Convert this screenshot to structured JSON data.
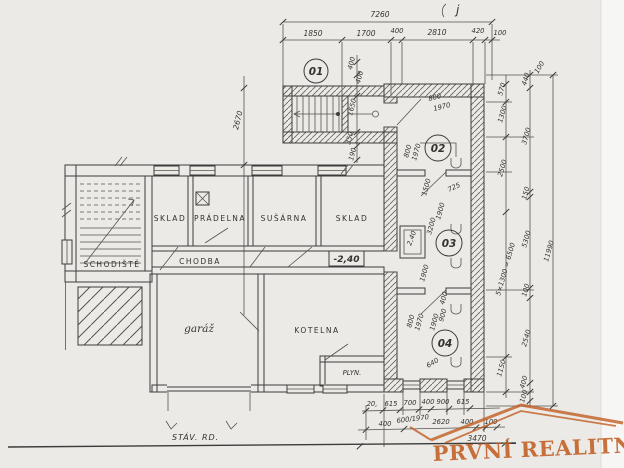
{
  "colors": {
    "ink": "#3c3c3c",
    "paper": "#ebeae6",
    "watermark": "#c05a1d"
  },
  "annotations": {
    "corner_mark": "j",
    "baseline_label": "STÁV. RD."
  },
  "rooms": {
    "n01": "01",
    "n02": "02",
    "n03": "03",
    "n04": "04",
    "schodiste": "SCHODIŠTĚ",
    "chodba": "CHODBA",
    "sklad1": "SKLAD",
    "pradelna": "PRÁDELNA",
    "susarna": "SUŠÁRNA",
    "sklad2": "SKLAD",
    "garaz": "garáž",
    "kotelna": "KOTELNA",
    "plyn": "PLYN.",
    "level_mark": "-2,40",
    "shaft_depth": "2,40"
  },
  "dims": {
    "top": {
      "total": "7260",
      "s0": "1850",
      "s1": "1700",
      "s2": "400",
      "s3": "2810",
      "s4": "420",
      "s5": "100"
    },
    "left": {
      "v": "2670"
    },
    "stair": {
      "a": "400",
      "b": "400",
      "c": "1650",
      "d": "350",
      "e": "190"
    },
    "right_inner": {
      "a": "570",
      "b": "1300",
      "c": "2500",
      "d": "5×1300 = 6500",
      "e": "1150"
    },
    "right_mid": {
      "top": "100",
      "a": "440",
      "b": "3700",
      "c": "150",
      "d": "5300",
      "e": "100",
      "f": "2540",
      "g": "400",
      "h": "100"
    },
    "right_outer": {
      "total": "11990"
    },
    "r02": {
      "a": "800",
      "b": "1970",
      "c": "800",
      "d": "1970",
      "e": "1500",
      "f": "725"
    },
    "r03": {
      "a": "1900",
      "b": "3200",
      "c": "1900"
    },
    "r04": {
      "a": "800",
      "b": "1970",
      "c": "1900",
      "d": "900",
      "e": "400",
      "f": "640"
    },
    "bottom": {
      "r1a": "20,",
      "r1b": "615",
      "r1c": "700",
      "r1d": "400",
      "r1e": "900",
      "r1f": "615",
      "note": "600/1970",
      "r2a": "400",
      "r2b": "2620",
      "r2c": "400",
      "r2d": "100",
      "total": "3470"
    }
  },
  "watermark": {
    "text": "PRVNÍ REALITNÍ"
  }
}
